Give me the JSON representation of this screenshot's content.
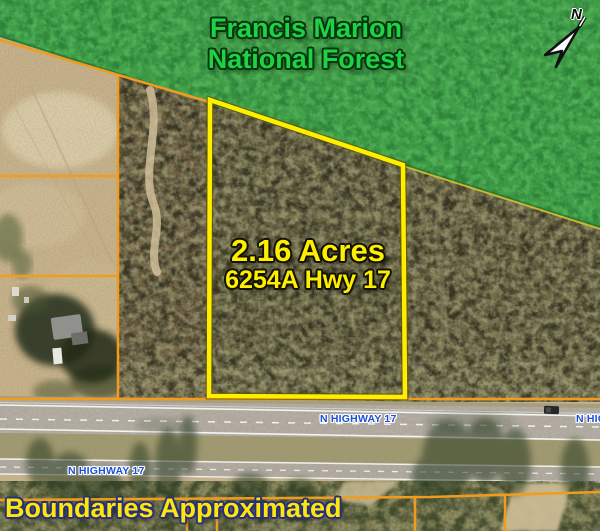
{
  "forest": {
    "line1": "Francis Marion",
    "line2": "National Forest"
  },
  "parcel": {
    "acreage": "2.16 Acres",
    "address": "6254A Hwy 17"
  },
  "highway": {
    "labels": [
      {
        "text": "N HIGHWAY 17"
      },
      {
        "text": "N HIGHWAY 17"
      },
      {
        "text": "N HIGHWAY 17"
      }
    ]
  },
  "disclaimer": "Boundaries Approximated",
  "north": {
    "label": "N"
  },
  "colors": {
    "parcel_outline": "#ffee00",
    "boundary_line": "#f29c1f",
    "forest_green": "#3f9e47",
    "forest_text": "#1fd144",
    "parcel_text": "#ffee00",
    "highway_text": "#1d4fd8",
    "disclaimer_text": "#ffe60a"
  }
}
